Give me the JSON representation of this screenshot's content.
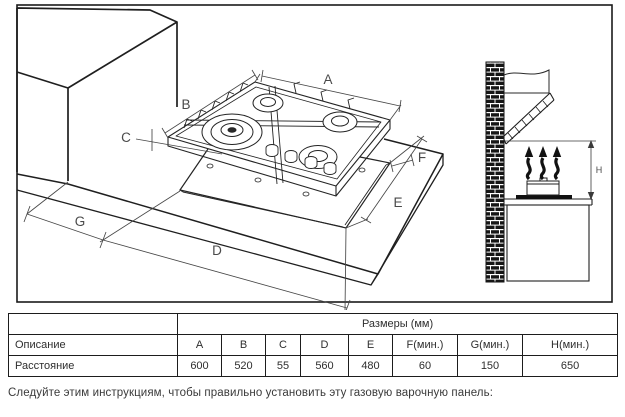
{
  "figure": {
    "labels": {
      "a": "A",
      "b": "B",
      "c": "C",
      "d": "D",
      "e": "E",
      "f": "F",
      "g": "G",
      "h": "H"
    }
  },
  "table": {
    "corner_cell": "",
    "size_header": "Размеры (мм)",
    "desc_label": "Описание",
    "desc_values": [
      "A",
      "B",
      "C",
      "D",
      "E",
      "F(мин.)",
      "G(мин.)",
      "H(мин.)"
    ],
    "dist_label": "Расстояние",
    "dist_values": [
      "600",
      "520",
      "55",
      "560",
      "480",
      "60",
      "150",
      "650"
    ]
  },
  "caption": "Следуйте этим инструкциям, чтобы правильно установить эту газовую варочную панель:",
  "colors": {
    "line": "#1f1f1f",
    "dim_line": "#474747",
    "label": "#4a4a4a"
  }
}
